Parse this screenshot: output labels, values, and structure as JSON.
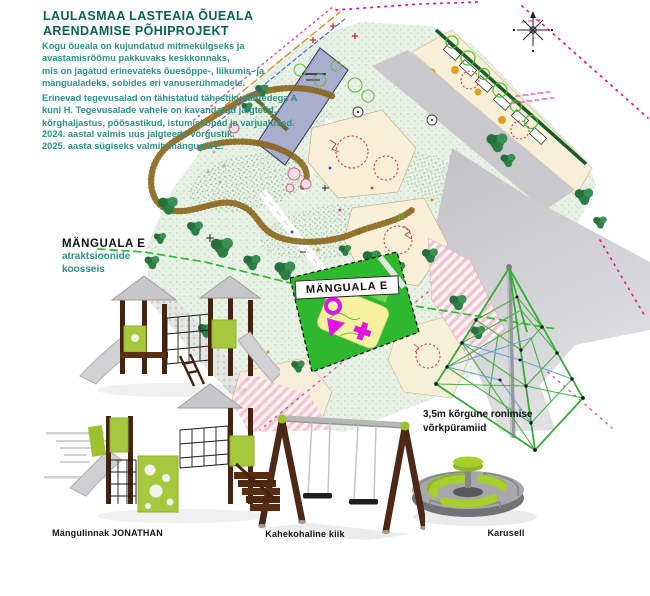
{
  "header": {
    "title_line1": "LAULASMAA LASTEAIA ÕUEALA",
    "title_line2": "ARENDAMISE PÕHIPROJEKT",
    "p1_lines": [
      "Kogu õueala on kujundatud mitmekülgseks ja",
      "avastamisrõõmu pakkuvaks keskkonnaks,",
      "mis on jagatud erinevateks õuesõppe-, liikumis- ja",
      "mängualadeks, sobides eri vanuserühmadele."
    ],
    "p2_lines": [
      "Erinevad tegevusalad on tähistatud tähestiku tähtedega A",
      "kuni H. Tegevusalade vahele on kavandatud jalgteed,",
      "kõrghaljastus, põõsastikud, istumiskohad ja varjualused."
    ],
    "p3_lines": [
      "2024. aastal valmis uus jalgteede võrgustik.",
      "2025. aasta sügiseks valmib mänguala E."
    ]
  },
  "left_callout": {
    "title": "MÄNGUALA E",
    "line1": "atraktsioonide",
    "line2": "koosseis"
  },
  "map": {
    "zone_label": "MÄNGUALA E",
    "area_letter": "R",
    "compass": "north-arrow"
  },
  "equipment": [
    {
      "id": "jonathan",
      "label": "Mängulinnak JONATHAN"
    },
    {
      "id": "swing",
      "label": "Kahekohaline kiik"
    },
    {
      "id": "carousel",
      "label": "Karusell"
    },
    {
      "id": "pyramid",
      "label_line1": "3,5m kõrgune ronimise",
      "label_line2": "võrkpüramiid"
    }
  ],
  "colors": {
    "title_teal": "#0b6155",
    "body_teal": "#2e9186",
    "zone_green": "#2eb82e",
    "icon_magenta": "#e313e3",
    "equipment_lime": "#a5c93c",
    "wood_brown": "#4a2714",
    "slide_gray": "#c9c9cb",
    "building_blue": "#a9aecf",
    "path_brown": "#8a671c",
    "plaza_gray": "#c6c6c8",
    "hedge_green": "#1c5a2c",
    "sand_cream": "#f7efd7",
    "pink_paving": "#f3c2cf"
  }
}
